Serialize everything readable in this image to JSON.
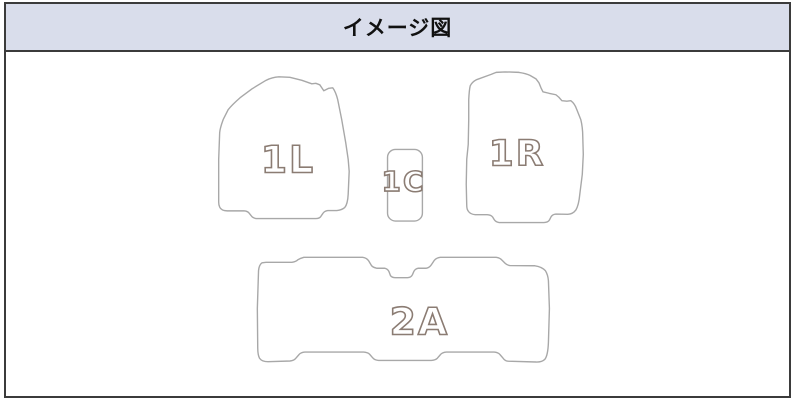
{
  "panel": {
    "title": "イメージ図"
  },
  "mats": [
    {
      "code": "1L",
      "position": "front-left"
    },
    {
      "code": "1C",
      "position": "front-center"
    },
    {
      "code": "1R",
      "position": "front-right"
    },
    {
      "code": "2A",
      "position": "second-row"
    }
  ],
  "colors": {
    "header_bg": "#d9ddeb",
    "frame_border": "#3b3b3b",
    "mat_outline": "#a8a8a8",
    "label_outline": "#8b7c73",
    "label_fill": "#ffffff",
    "body_bg": "#ffffff"
  }
}
